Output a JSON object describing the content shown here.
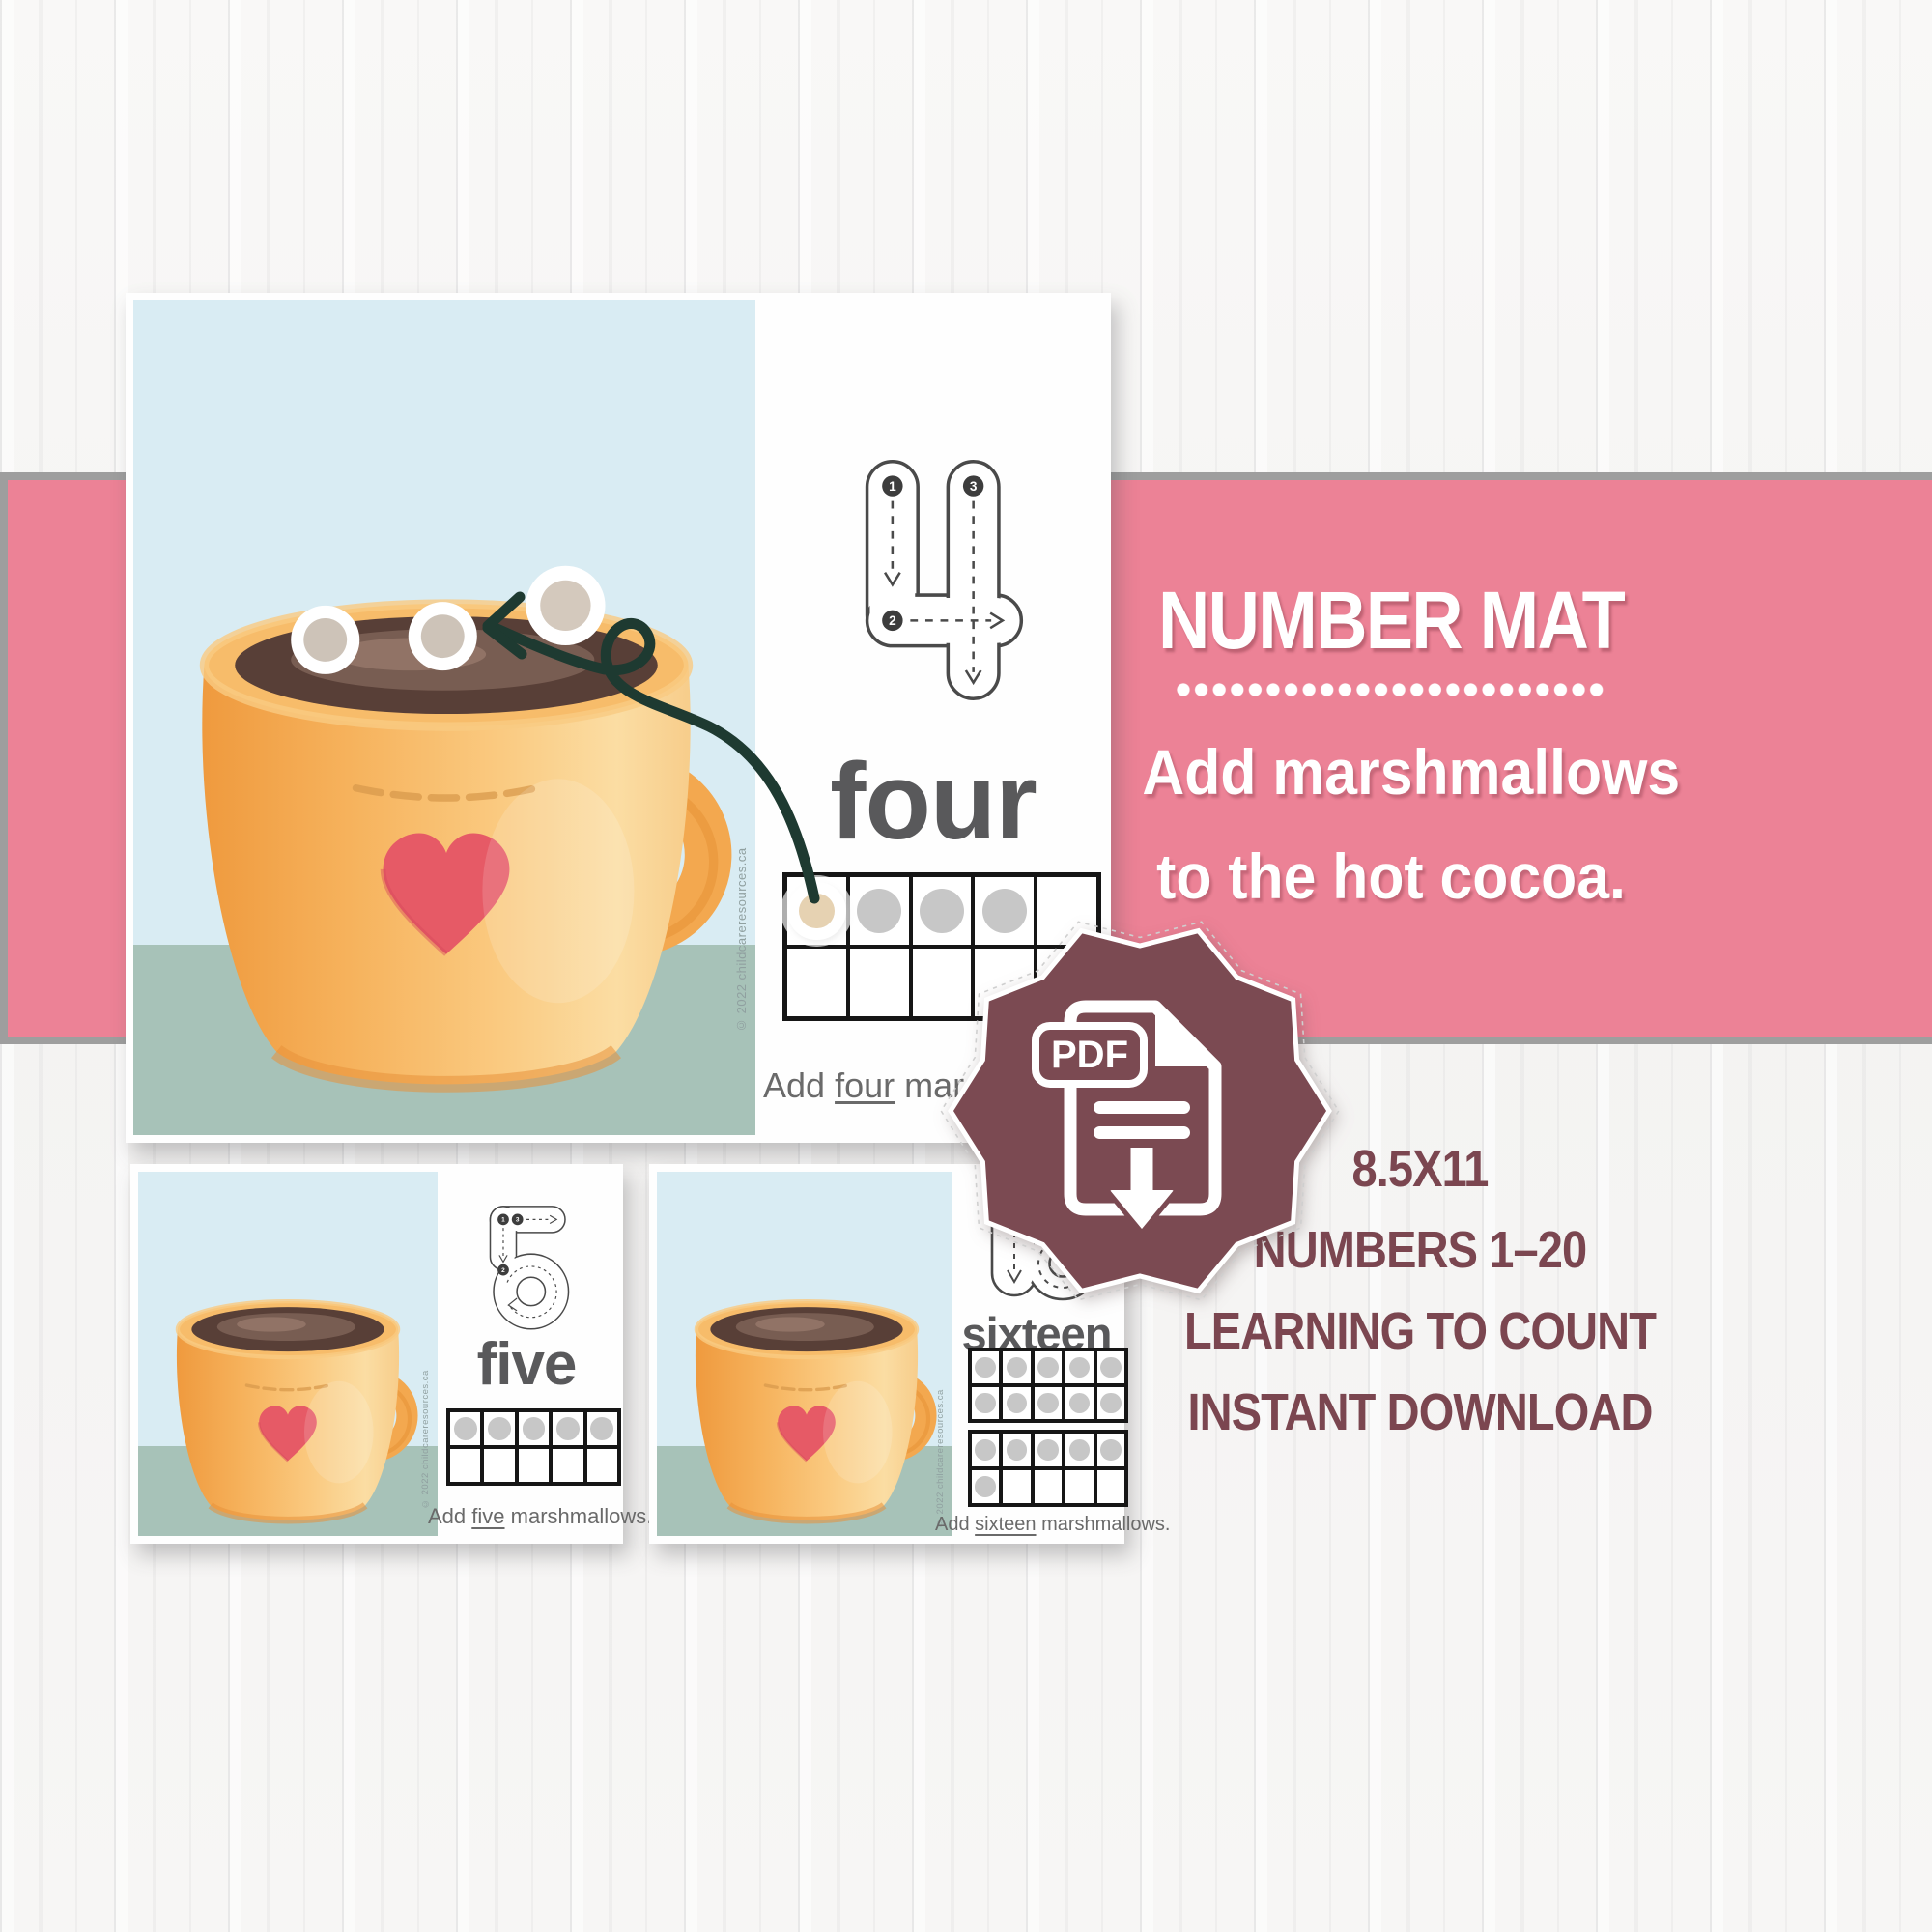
{
  "banner": {
    "title": "NUMBER MAT",
    "line1": "Add marshmallows",
    "line2": "to the hot cocoa."
  },
  "features": {
    "lines": [
      "8.5X11",
      "NUMBERS 1–20",
      "LEARNING TO COUNT",
      "INSTANT DOWNLOAD"
    ]
  },
  "badge": {
    "label": "PDF"
  },
  "cards": {
    "main": {
      "word": "four",
      "trace_steps": [
        "1",
        "2",
        "3"
      ],
      "instruction": {
        "prefix": "Add ",
        "word": "four",
        "suffix": " marshmallows."
      },
      "copyright": "© 2022 childcareresources.ca",
      "ten_frame": [
        "marshmallow",
        "dot",
        "dot",
        "dot",
        "empty",
        "empty",
        "empty",
        "empty",
        "empty",
        "empty"
      ]
    },
    "five": {
      "word": "five",
      "trace_steps": [
        "1",
        "2",
        "3"
      ],
      "instruction": {
        "prefix": "Add ",
        "word": "five",
        "suffix": " marshmallows."
      },
      "copyright": "© 2022 childcareresources.ca",
      "ten_frame": [
        "dot",
        "dot",
        "dot",
        "dot",
        "dot",
        "empty",
        "empty",
        "empty",
        "empty",
        "empty"
      ]
    },
    "sixteen": {
      "word": "sixteen",
      "instruction": {
        "prefix": "Add ",
        "word": "sixteen",
        "suffix": " marshmallows."
      },
      "copyright": "© 2022 childcareresources.ca",
      "ten_frames": [
        [
          "dot",
          "dot",
          "dot",
          "dot",
          "dot",
          "dot",
          "dot",
          "dot",
          "dot",
          "dot"
        ],
        [
          "dot",
          "dot",
          "dot",
          "dot",
          "dot",
          "dot",
          "empty",
          "empty",
          "empty",
          "empty"
        ]
      ]
    }
  },
  "colors": {
    "band-pink": "#ec8296",
    "band-border": "#9e9e9e",
    "maroon": "#7b4a52",
    "text-maroon": "#7b4650",
    "sky": "#d9ecf3",
    "table-green": "#a7c2b8",
    "mug-orange": "#f6b25c",
    "heart-red": "#e65a66",
    "cocoa-brown": "#583f37",
    "arrow-green": "#1e3a31",
    "dot-gray": "#c7c7c7",
    "trace-gray": "#4a4a4a",
    "word-gray": "#59595b",
    "wood-bg": "#f6f5f4"
  }
}
